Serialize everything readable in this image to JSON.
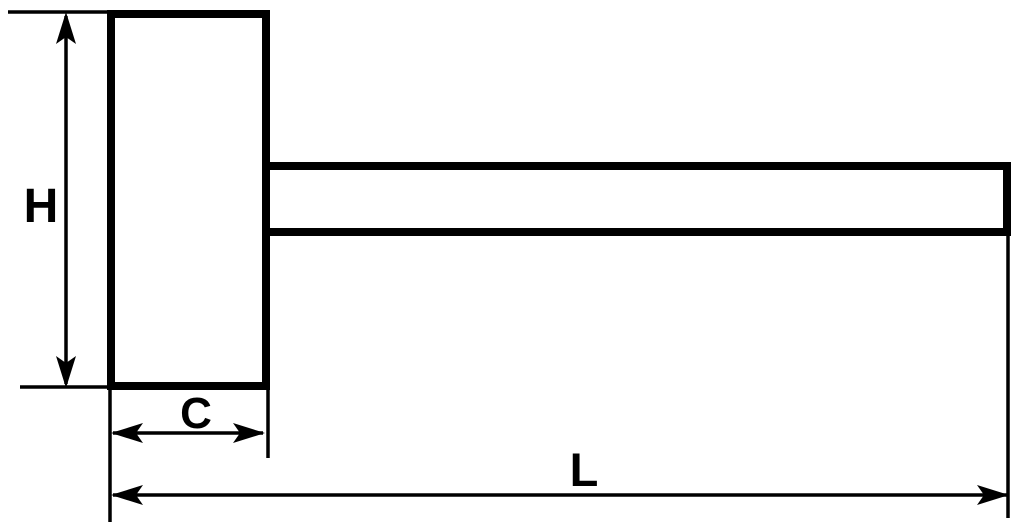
{
  "diagram": {
    "labels": {
      "H": "H",
      "C": "C",
      "L": "L"
    },
    "colors": {
      "ink": "#000000",
      "background": "#ffffff"
    }
  }
}
